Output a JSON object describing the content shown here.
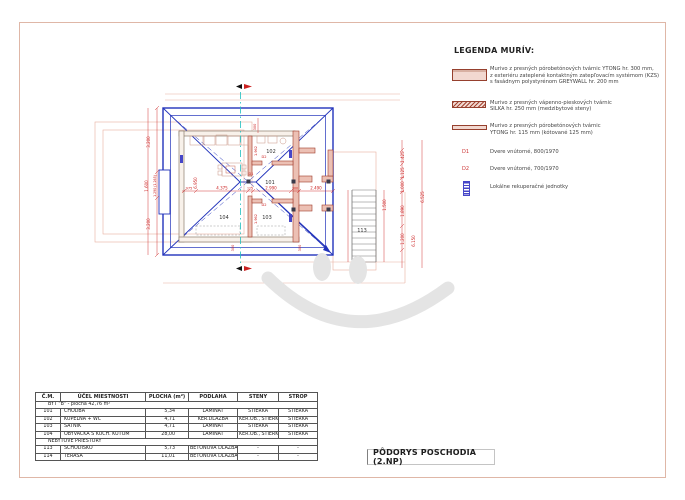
{
  "colors": {
    "dimension_red": "#cc2222",
    "roof_blue": "#2233bb",
    "wall_pink": "#ecc0b4",
    "wall_border": "#a03a2a",
    "section_cyan": "#1fbfbf",
    "watermark_gray": "#e4e4e4",
    "frame_salmon": "#dfb7a7"
  },
  "legend": {
    "title": "LEGENDA MURÍV:",
    "items": [
      {
        "name": "ytong-300",
        "text": "Murivo z presných pórobetónových tvárnic YTONG hr. 300 mm,\nz exteriéru zateplené kontaktným zatepľovacím systémom (KZS)\ns fasádnym polystyrénom GREYWALL hr. 200 mm"
      },
      {
        "name": "silka-250",
        "text": "Murivo z presných vápenno-pieskových tvárnic\nSILKA hr. 250 mm (medzibytové steny)"
      },
      {
        "name": "ytong-115",
        "text": "Murivo z presných pórobetónových tvárnic\nYTONG hr. 115 mm (kótované 125 mm)"
      }
    ],
    "doors": [
      {
        "code": "D1",
        "text": "Dvere vnútorné, 800/1970"
      },
      {
        "code": "D2",
        "text": "Dvere vnútorné, 700/1970"
      }
    ],
    "recuperation": {
      "text": "Lokálne rekuperačné jednotky"
    }
  },
  "plan": {
    "rooms": [
      "101",
      "102",
      "103",
      "104",
      "113"
    ],
    "door_labels": [
      "D1",
      "D2",
      "D2"
    ],
    "dims": [
      "3.200",
      "1.290 (1.265)",
      "1.600",
      "3.200",
      "6.950",
      "975",
      "4.375",
      "125",
      "2.990",
      "300",
      "2.490",
      "1.962",
      "1.962",
      "300",
      "300",
      "300",
      "1.425",
      "1.125",
      "1.000",
      "1.890",
      "1.200",
      "6.525",
      "1.500",
      "6.150"
    ]
  },
  "table": {
    "headers": [
      "Č.M.",
      "ÚČEL MIESTNOSTI",
      "PLOCHA (m²)",
      "PODLAHA",
      "STENY",
      "STROP"
    ],
    "group1": "BYT \"B\" - plocha 42,76 m²",
    "rows": [
      [
        "101",
        "CHODBA",
        "5,34",
        "LAMINÁT",
        "STIERKA",
        "STIERKA"
      ],
      [
        "102",
        "KÚPEĽŇA + WC",
        "4,71",
        "KER.DLAŽBA",
        "KER.OB., STIERKA",
        "STIERKA"
      ],
      [
        "103",
        "ŠATNÍK",
        "4,71",
        "LAMINÁT",
        "STIERKA",
        "STIERKA"
      ],
      [
        "104",
        "OBÝVAČKA S KUCH. KÚTOM",
        "28,00",
        "LAMINÁT",
        "KER.OB., STIERKA",
        "STIERKA"
      ]
    ],
    "group2": "NEBYTOVÉ PRIESTORY",
    "rows2": [
      [
        "113",
        "SCHODISKO",
        "5,73",
        "BETÓNOVÁ DLAŽBA",
        "-",
        "-"
      ],
      [
        "114",
        "TERASA",
        "11,01",
        "BETÓNOVÁ DLAŽBA",
        "-",
        "-"
      ]
    ]
  },
  "title_block": {
    "title": "PÔDORYS POSCHODIA (2.NP)"
  }
}
